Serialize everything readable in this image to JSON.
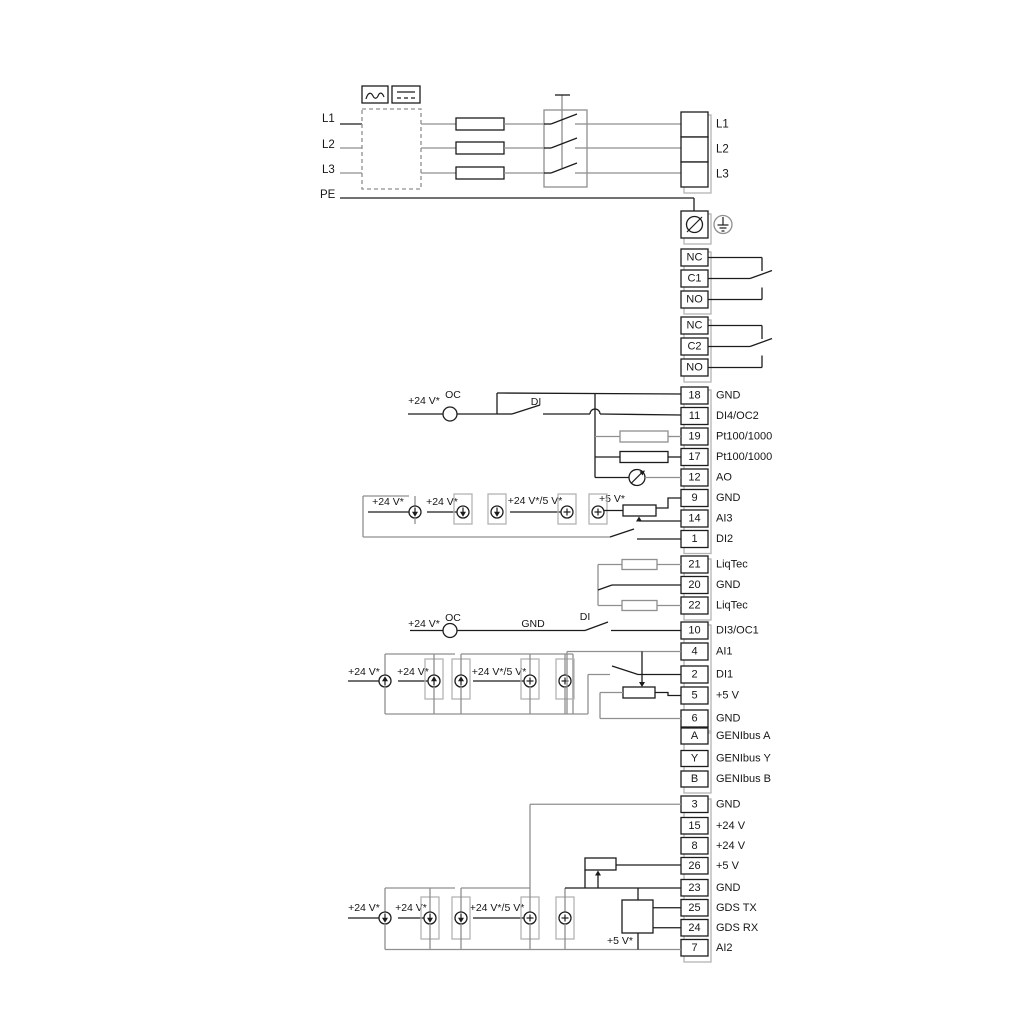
{
  "diagram": {
    "power_inputs": [
      "L1",
      "L2",
      "L3",
      "PE"
    ],
    "power_outputs": [
      "L1",
      "L2",
      "L3"
    ],
    "relay_groups": [
      {
        "terminals": [
          "NC",
          "C1",
          "NO"
        ]
      },
      {
        "terminals": [
          "NC",
          "C2",
          "NO"
        ]
      }
    ],
    "terminal_groups": {
      "io1": [
        {
          "num": "18",
          "label": "GND"
        },
        {
          "num": "11",
          "label": "DI4/OC2"
        },
        {
          "num": "19",
          "label": "Pt100/1000"
        },
        {
          "num": "17",
          "label": "Pt100/1000"
        },
        {
          "num": "12",
          "label": "AO"
        },
        {
          "num": "9",
          "label": "GND"
        },
        {
          "num": "14",
          "label": "AI3"
        },
        {
          "num": "1",
          "label": "DI2"
        }
      ],
      "liqtec": [
        {
          "num": "21",
          "label": "LiqTec"
        },
        {
          "num": "20",
          "label": "GND"
        },
        {
          "num": "22",
          "label": "LiqTec"
        }
      ],
      "io2": [
        {
          "num": "10",
          "label": "DI3/OC1"
        },
        {
          "num": "4",
          "label": "AI1"
        },
        {
          "num": "2",
          "label": "DI1"
        },
        {
          "num": "5",
          "label": "+5 V"
        },
        {
          "num": "6",
          "label": "GND"
        }
      ],
      "genibus": [
        {
          "num": "A",
          "label": "GENIbus A"
        },
        {
          "num": "Y",
          "label": "GENIbus Y"
        },
        {
          "num": "B",
          "label": "GENIbus B"
        }
      ],
      "io3": [
        {
          "num": "3",
          "label": "GND"
        },
        {
          "num": "15",
          "label": "+24 V"
        },
        {
          "num": "8",
          "label": "+24 V"
        },
        {
          "num": "26",
          "label": "+5 V"
        },
        {
          "num": "23",
          "label": "GND"
        },
        {
          "num": "25",
          "label": "GDS TX"
        },
        {
          "num": "24",
          "label": "GDS RX"
        },
        {
          "num": "7",
          "label": "AI2"
        }
      ]
    },
    "annotations": {
      "v24": "+24 V*",
      "v24_5": "+24 V*/5 V*",
      "v5": "+5 V*",
      "oc": "OC",
      "di": "DI",
      "gnd": "GND"
    },
    "colors": {
      "line_black": "#1c1c1c",
      "line_gray": "#8f8f8f",
      "strip_gray": "#b4b4b4"
    }
  }
}
